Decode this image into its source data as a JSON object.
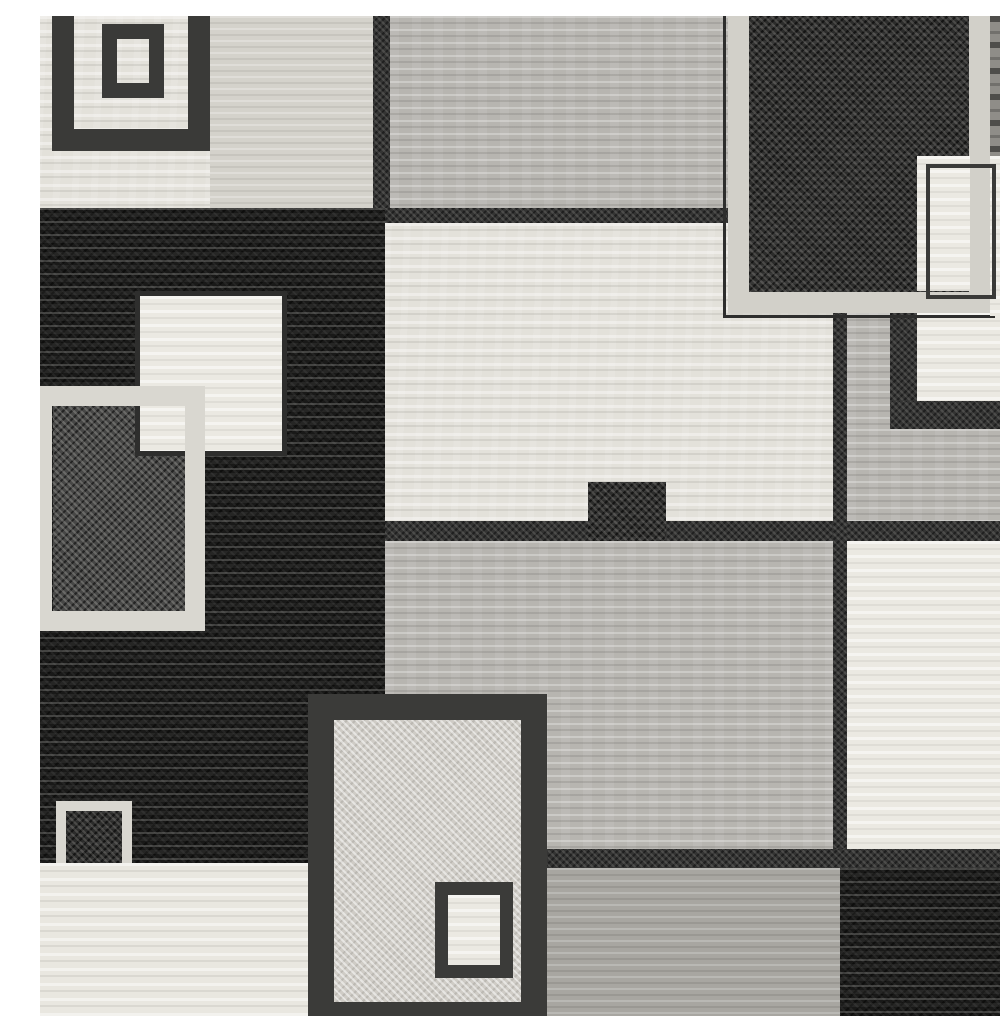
{
  "figure": {
    "alt": "Black gray and white modern geometric patchwork area rug, overlapping squares pattern, full-bleed product photo"
  },
  "palette": {
    "cream": "#e3e1da",
    "cream-bright": "#e9e7e0",
    "greige": "#d4d2cb",
    "gray": "#b7b5b0",
    "taupe": "#a8a6a1",
    "white": "#ebe9e2",
    "black": "#191918",
    "charcoal-speckle": "#2c2c2b",
    "darkgray-speckle": "#474746",
    "light-speckle": "#cfccc6",
    "darkline": "#343433",
    "gray-streak-dark": "#8f8d88",
    "border-dark": "#3a3a38",
    "border-light": "#d9d7d0"
  },
  "shapes": [
    {
      "name": "base-field",
      "x": 0,
      "y": 0,
      "w": 1000,
      "h": 1000,
      "tx": "cream"
    },
    {
      "name": "top-left-cream-block",
      "x": 0,
      "y": 0,
      "w": 170,
      "h": 194,
      "tx": "cream"
    },
    {
      "name": "top-left-greige-block",
      "x": 170,
      "y": 0,
      "w": 175,
      "h": 194,
      "tx": "greige"
    },
    {
      "name": "top-left-outer-square-frame",
      "x": 12,
      "y": -45,
      "w": 158,
      "h": 180,
      "tx": "none",
      "border": {
        "w": 22,
        "c": "#3a3a38"
      }
    },
    {
      "name": "top-left-inner-square-frame",
      "x": 62,
      "y": 8,
      "w": 62,
      "h": 74,
      "tx": "none",
      "border": {
        "w": 15,
        "c": "#3a3a38"
      }
    },
    {
      "name": "top-left-vertical-divider",
      "x": 333,
      "y": 0,
      "w": 17,
      "h": 196,
      "tx": "darkline"
    },
    {
      "name": "top-center-gray-block",
      "x": 350,
      "y": 0,
      "w": 340,
      "h": 196,
      "tx": "gray"
    },
    {
      "name": "top-center-dark-rule",
      "x": 345,
      "y": 192,
      "w": 345,
      "h": 15,
      "tx": "darkline"
    },
    {
      "name": "left-black-field",
      "x": 0,
      "y": 192,
      "w": 345,
      "h": 655,
      "tx": "black"
    },
    {
      "name": "left-outlined-square-fill",
      "x": 13,
      "y": 390,
      "w": 134,
      "h": 205,
      "tx": "darkgray-speckle"
    },
    {
      "name": "left-cream-square",
      "x": 95,
      "y": 275,
      "w": 152,
      "h": 165,
      "tx": "white",
      "border": {
        "w": 5,
        "c": "#2e2e2d"
      }
    },
    {
      "name": "left-white-square-frame",
      "x": -8,
      "y": 370,
      "w": 173,
      "h": 245,
      "tx": "none",
      "border": {
        "w": 20,
        "c": "#d9d7d0"
      }
    },
    {
      "name": "small-white-framed-square",
      "x": 16,
      "y": 785,
      "w": 76,
      "h": 102,
      "tx": "charcoal-speckle",
      "border": {
        "w": 10,
        "c": "#d9d7d0"
      }
    },
    {
      "name": "center-cream-field",
      "x": 345,
      "y": 207,
      "w": 462,
      "h": 300,
      "tx": "cream"
    },
    {
      "name": "right-gray-bar",
      "x": 807,
      "y": 297,
      "w": 45,
      "h": 120,
      "tx": "gray"
    },
    {
      "name": "right-dark-strip",
      "x": 850,
      "y": 275,
      "w": 27,
      "h": 140,
      "tx": "darkline"
    },
    {
      "name": "right-white-patch",
      "x": 877,
      "y": 297,
      "w": 123,
      "h": 90,
      "tx": "white"
    },
    {
      "name": "right-dark-band",
      "x": 850,
      "y": 385,
      "w": 150,
      "h": 30,
      "tx": "darkline"
    },
    {
      "name": "right-gray-block",
      "x": 807,
      "y": 413,
      "w": 193,
      "h": 94,
      "tx": "gray"
    },
    {
      "name": "mid-dark-stripe",
      "x": 345,
      "y": 505,
      "w": 655,
      "h": 20,
      "tx": "darkline"
    },
    {
      "name": "center-accent-square",
      "x": 548,
      "y": 466,
      "w": 78,
      "h": 106,
      "tx": "charcoal-speckle"
    },
    {
      "name": "center-gray-field",
      "x": 345,
      "y": 525,
      "w": 448,
      "h": 312,
      "tx": "gray"
    },
    {
      "name": "right-vertical-divider",
      "x": 793,
      "y": 295,
      "w": 14,
      "h": 542,
      "tx": "darkline"
    },
    {
      "name": "right-white-field",
      "x": 807,
      "y": 525,
      "w": 193,
      "h": 310,
      "tx": "white"
    },
    {
      "name": "top-right-square-fill",
      "x": 709,
      "y": 0,
      "w": 221,
      "h": 276,
      "tx": "charcoal-speckle"
    },
    {
      "name": "top-right-square-frame",
      "x": 688,
      "y": -30,
      "w": 262,
      "h": 327,
      "tx": "none",
      "border": {
        "w": 21,
        "c": "#d2d0c9"
      }
    },
    {
      "name": "top-right-square-thin-outline",
      "x": 683,
      "y": -32,
      "w": 272,
      "h": 334,
      "tx": "none",
      "border": {
        "w": 3,
        "c": "#2e2e2d"
      }
    },
    {
      "name": "top-right-corner-gray",
      "x": 950,
      "y": 0,
      "w": 50,
      "h": 140,
      "tx": "gray-streak-dark"
    },
    {
      "name": "top-right-white-column",
      "x": 950,
      "y": 140,
      "w": 50,
      "h": 160,
      "tx": "white"
    },
    {
      "name": "top-right-white-overlay-square",
      "x": 877,
      "y": 140,
      "w": 53,
      "h": 135,
      "tx": "white"
    },
    {
      "name": "top-right-thin-outline-square",
      "x": 886,
      "y": 148,
      "w": 70,
      "h": 135,
      "tx": "none",
      "border": {
        "w": 4,
        "c": "#3a3a38"
      }
    },
    {
      "name": "bottom-dark-stripe",
      "x": 503,
      "y": 833,
      "w": 497,
      "h": 19,
      "tx": "darkline"
    },
    {
      "name": "bottom-taupe-field",
      "x": 503,
      "y": 852,
      "w": 297,
      "h": 148,
      "tx": "taupe"
    },
    {
      "name": "bottom-right-black-block",
      "x": 800,
      "y": 852,
      "w": 200,
      "h": 148,
      "tx": "black"
    },
    {
      "name": "bottom-left-cream-field",
      "x": 0,
      "y": 847,
      "w": 268,
      "h": 153,
      "tx": "cream-bright"
    },
    {
      "name": "bottom-center-square-fill",
      "x": 294,
      "y": 704,
      "w": 189,
      "h": 284,
      "tx": "light-speckle"
    },
    {
      "name": "bottom-center-square-frame",
      "x": 268,
      "y": 678,
      "w": 239,
      "h": 334,
      "tx": "none",
      "border": {
        "w": 26,
        "c": "#3b3b39"
      }
    },
    {
      "name": "bottom-center-inner-square",
      "x": 395,
      "y": 866,
      "w": 78,
      "h": 96,
      "tx": "white",
      "border": {
        "w": 13,
        "c": "#3b3b39"
      }
    }
  ]
}
